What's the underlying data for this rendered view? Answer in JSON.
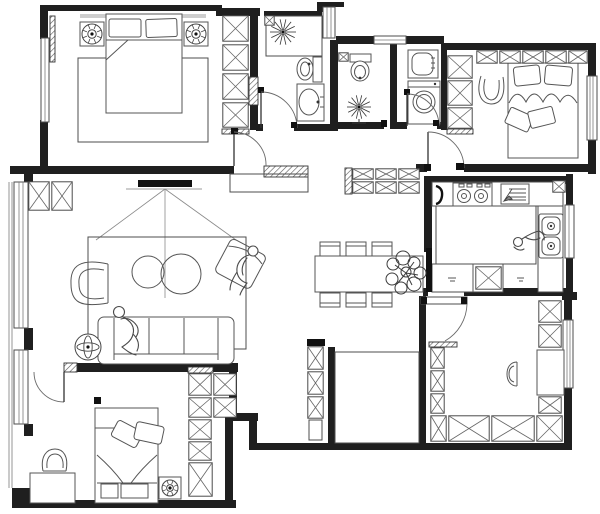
{
  "document": {
    "type": "residential-apartment-floor-plan",
    "style": "black-and-white CAD line drawing, top view",
    "visible_text": "none"
  },
  "colors": {
    "background": "#ffffff",
    "walls": "#1f1f1f",
    "furniture_lines": "#555555",
    "hatch": "#555555"
  },
  "rooms": [
    {
      "name": "master-bedroom",
      "position": "top-left",
      "furniture": [
        "double-bed",
        "pillow x2",
        "nightstand x2",
        "table-lamp x2",
        "area-rug",
        "wardrobe-4-sections",
        "window-left",
        "curtain-rail"
      ]
    },
    {
      "name": "bathroom-1",
      "position": "top-center-left",
      "furniture": [
        "shower-spray-symbol",
        "toilet",
        "pedestal-sink",
        "corner-shelf",
        "swing-door"
      ]
    },
    {
      "name": "bathroom-2",
      "position": "top-center",
      "furniture": [
        "toilet",
        "floor-drain-symbol",
        "corner-shelf"
      ]
    },
    {
      "name": "laundry-nook",
      "position": "top-center-right",
      "furniture": [
        "washbasin",
        "washing-machine",
        "swing-door"
      ]
    },
    {
      "name": "bedroom-2",
      "position": "top-right",
      "furniture": [
        "double-bed",
        "pillow x2",
        "cushion x2",
        "hanging-chair",
        "overhead-cabinet-row",
        "wardrobe-3-sections",
        "window-right",
        "swing-door"
      ]
    },
    {
      "name": "kitchen",
      "position": "right-middle",
      "furniture": [
        "counter-top",
        "gas-stove-2-burner",
        "cutting-board-with-knife",
        "flue-box",
        "double-bowl-sink",
        "island-counter",
        "base-cabinet",
        "person-cooking",
        "window-right",
        "black-sliding-door"
      ]
    },
    {
      "name": "dining-area",
      "position": "center",
      "furniture": [
        "dining-table",
        "dining-chair x6",
        "potted-plant",
        "sideboard-cabinet-6-cells"
      ]
    },
    {
      "name": "living-room",
      "position": "left-middle",
      "furniture": [
        "tv-on-wall",
        "tv-projection-lines",
        "sofa-3-seat",
        "person-on-sofa",
        "armchair",
        "accent-chair-rotated",
        "person-on-chair",
        "round-coffee-table x2",
        "floor-lamp",
        "area-rug",
        "shoe-cabinet-2-cells",
        "balcony-window-left"
      ]
    },
    {
      "name": "bedroom-3",
      "position": "bottom-left",
      "furniture": [
        "double-bed",
        "pillow x2",
        "foot-bench x2",
        "desk",
        "desk-chair",
        "nightstand",
        "table-lamp",
        "wardrobe-7-sections",
        "window-left",
        "swing-door"
      ]
    },
    {
      "name": "study",
      "position": "bottom-right",
      "furniture": [
        "desk",
        "chair",
        "bookcase-left-column",
        "bookcase-bottom-row",
        "bookcase-right-column",
        "window-right",
        "swing-door-open"
      ]
    },
    {
      "name": "hallway",
      "position": "center-bottom",
      "furniture": [
        "storage-column",
        "void-alcove"
      ]
    }
  ],
  "symbols": {
    "stars": [
      {
        "name": "shower-spray",
        "x": 283,
        "y": 32,
        "r": 13
      },
      {
        "name": "floor-drain",
        "x": 359,
        "y": 107,
        "r": 12
      }
    ],
    "target_lamps": [
      {
        "name": "master-lamp-left",
        "x": 92,
        "y": 34,
        "r": 10
      },
      {
        "name": "master-lamp-right",
        "x": 196,
        "y": 34,
        "r": 10
      },
      {
        "name": "bedroom3-lamp",
        "x": 170,
        "y": 488,
        "r": 8
      }
    ],
    "floor_lamp": {
      "x": 88,
      "y": 347,
      "r": 13
    }
  },
  "cabinets": {
    "master_wardrobe": [
      [
        222,
        15,
        27,
        27
      ],
      [
        222,
        44,
        27,
        27
      ],
      [
        222,
        73,
        27,
        27
      ],
      [
        222,
        102,
        27,
        26
      ]
    ],
    "shoe_cabinet": [
      [
        28,
        181,
        22,
        30
      ],
      [
        51,
        181,
        22,
        30
      ]
    ],
    "dining_sideboard": [
      [
        352,
        168,
        22,
        12
      ],
      [
        375,
        168,
        22,
        12
      ],
      [
        398,
        168,
        22,
        12
      ],
      [
        352,
        181,
        22,
        13
      ],
      [
        375,
        181,
        22,
        13
      ],
      [
        398,
        181,
        22,
        13
      ]
    ],
    "bedroom2_top_row": [
      [
        476,
        50,
        22,
        14
      ],
      [
        499,
        50,
        22,
        14
      ],
      [
        522,
        50,
        22,
        14
      ],
      [
        545,
        50,
        22,
        14
      ],
      [
        568,
        50,
        20,
        14
      ]
    ],
    "bedroom2_side_col": [
      [
        447,
        55,
        26,
        24
      ],
      [
        447,
        80,
        26,
        26
      ],
      [
        447,
        107,
        26,
        22
      ]
    ],
    "hall_column": [
      [
        307,
        346,
        17,
        24
      ],
      [
        307,
        371,
        17,
        24
      ],
      [
        307,
        396,
        17,
        23
      ]
    ],
    "bedroom3_wardrobe": [
      [
        188,
        373,
        24,
        23
      ],
      [
        213,
        373,
        24,
        23
      ],
      [
        188,
        397,
        24,
        21
      ],
      [
        213,
        397,
        24,
        21
      ],
      [
        188,
        419,
        24,
        21
      ],
      [
        188,
        441,
        24,
        20
      ],
      [
        188,
        462,
        25,
        35
      ]
    ],
    "study_left_col": [
      [
        430,
        347,
        15,
        22
      ],
      [
        430,
        370,
        15,
        22
      ],
      [
        430,
        393,
        15,
        21
      ]
    ],
    "study_bottom_row": [
      [
        430,
        415,
        17,
        27
      ],
      [
        448,
        415,
        42,
        27
      ],
      [
        491,
        415,
        44,
        27
      ],
      [
        536,
        415,
        27,
        27
      ]
    ],
    "study_right_col": [
      [
        538,
        300,
        24,
        23
      ],
      [
        538,
        324,
        24,
        24
      ],
      [
        538,
        396,
        24,
        18
      ]
    ],
    "kitchen_base_cell": [
      [
        475,
        266,
        27,
        24
      ]
    ],
    "flue_box": [
      [
        552,
        180,
        14,
        13
      ]
    ],
    "bath1_shelf": [
      [
        264,
        15,
        11,
        11
      ]
    ],
    "bath2_shelf": [
      [
        338,
        52,
        11,
        10
      ]
    ]
  }
}
